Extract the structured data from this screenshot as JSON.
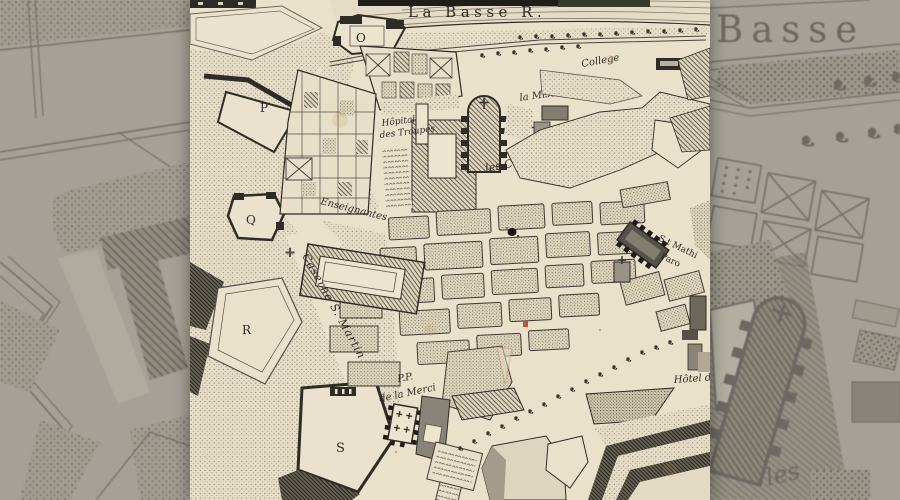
{
  "map": {
    "labels": {
      "river": "La Basse R.",
      "college": "College",
      "misericorde": "la Misericorde",
      "cordeliers": "les Cordeliers",
      "hopital_line1": "Hôpital",
      "hopital_line2": "des Troupes",
      "enseignantes": "Enseignantes",
      "caserne": "Caserne S. Martin",
      "merci_line1": "P.P.",
      "merci_line2": "de la Merci",
      "hotel": "Hôtel d",
      "st_mathieu_line1": "S.t Mathi",
      "st_mathieu_line2": "Paro",
      "bastion_o": "O",
      "bastion_p": "P",
      "bastion_q": "Q",
      "bastion_r": "R",
      "bastion_s": "S"
    },
    "colors": {
      "parchment": "#e9e1ca",
      "ink": "#2e2a24",
      "block_fill": "#ded5bd",
      "backdrop_base": "#a6a196",
      "backdrop_ink": "#6d6862",
      "red_mark": "#c4503a"
    }
  },
  "backdrop": {
    "basse": "Basse",
    "les": "les"
  }
}
